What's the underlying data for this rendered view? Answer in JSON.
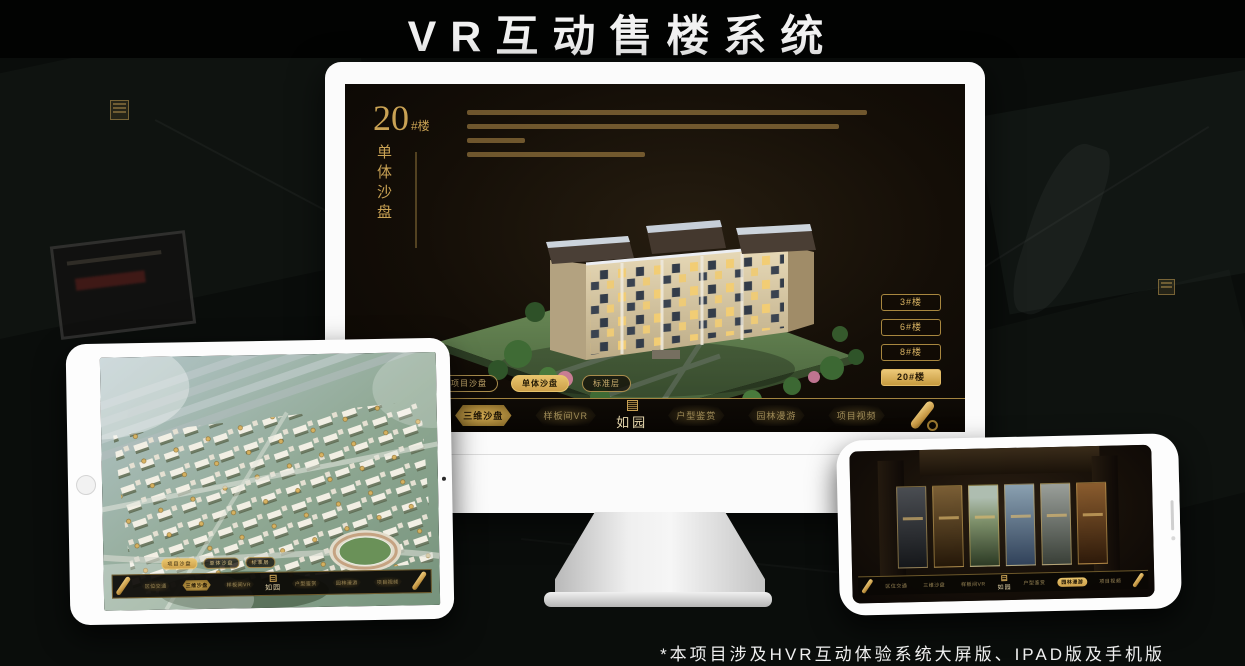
{
  "page": {
    "title": "VR互动售楼系统",
    "footnote": "*本项目涉及HVR互动体验系统大屏版、IPAD版及手机版"
  },
  "colors": {
    "gold": "#c9a254",
    "gold_bright": "#e2bb66",
    "screen_background": "#171108",
    "page_background": "#0a0d0b",
    "title_text": "#f2f2f2"
  },
  "monitor": {
    "heading": {
      "number": "20",
      "suffix": "#楼",
      "subtitle_vertical": "单体沙盘"
    },
    "building_buttons": [
      {
        "label": "3#楼",
        "active": false
      },
      {
        "label": "6#楼",
        "active": false
      },
      {
        "label": "8#楼",
        "active": false
      },
      {
        "label": "20#楼",
        "active": true
      }
    ],
    "sub_tabs": [
      {
        "label": "项目沙盘",
        "active": false
      },
      {
        "label": "单体沙盘",
        "active": true
      },
      {
        "label": "标准层",
        "active": false
      }
    ],
    "nav": {
      "logo": "如园",
      "items": [
        {
          "label": "区位交通",
          "active": false
        },
        {
          "label": "三维沙盘",
          "active": true
        },
        {
          "label": "样板间VR",
          "active": false
        },
        {
          "label": "户型鉴赏",
          "active": false
        },
        {
          "label": "园林漫游",
          "active": false
        },
        {
          "label": "项目视频",
          "active": false
        }
      ]
    }
  },
  "tablet": {
    "sub_tabs": [
      {
        "label": "项目沙盘",
        "active": true
      },
      {
        "label": "单体沙盘",
        "active": false
      },
      {
        "label": "标准层",
        "active": false
      }
    ],
    "nav": {
      "logo": "如园",
      "items": [
        {
          "label": "区位交通",
          "active": false
        },
        {
          "label": "三维沙盘",
          "active": true
        },
        {
          "label": "样板间VR",
          "active": false
        },
        {
          "label": "户型鉴赏",
          "active": false
        },
        {
          "label": "园林漫游",
          "active": false
        },
        {
          "label": "项目视频",
          "active": false
        }
      ]
    }
  },
  "phone": {
    "nav": {
      "logo": "如园",
      "items": [
        {
          "label": "区位交通",
          "active": false
        },
        {
          "label": "三维沙盘",
          "active": false
        },
        {
          "label": "样板间VR",
          "active": false
        },
        {
          "label": "户型鉴赏",
          "active": false
        },
        {
          "label": "园林漫游",
          "active": true
        },
        {
          "label": "项目视频",
          "active": false
        }
      ]
    }
  }
}
